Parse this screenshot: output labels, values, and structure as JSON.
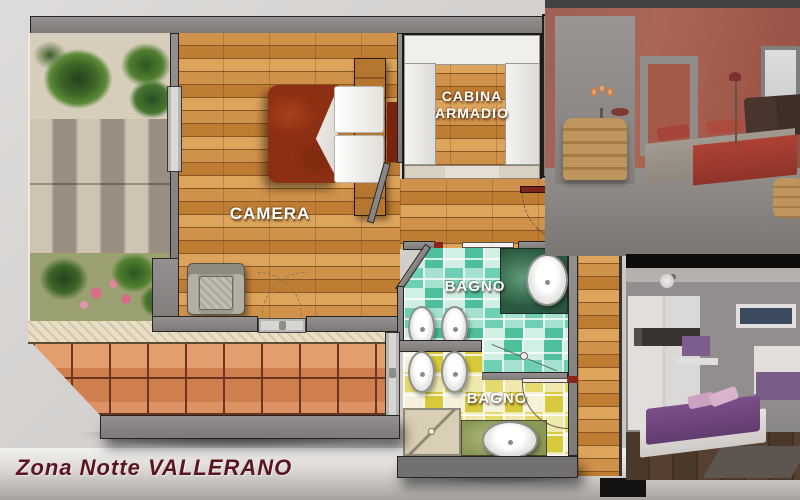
{
  "title_bar": {
    "caption": "Zona Notte VALLERANO"
  },
  "floorplan": {
    "rooms": {
      "camera": {
        "label": "CAMERA"
      },
      "cabina": {
        "line1": "CABINA",
        "line2": "ARMADIO"
      },
      "bagno1": {
        "label": "BAGNO"
      },
      "bagno2": {
        "label": "BAGNO"
      }
    },
    "colors": {
      "wall": "#868280",
      "wood": "#c8853f",
      "terracotta": "#cf7f4e",
      "teal_tile": "#5ec7a8",
      "yellow_tile": "#ddd23a",
      "marble": "#e9dfc6",
      "bed": "#8d2f12",
      "caption_text": "#5a1620"
    }
  },
  "photos": {
    "top": {
      "name": "red-bedroom-photo"
    },
    "bottom": {
      "name": "purple-bedroom-photo"
    }
  }
}
